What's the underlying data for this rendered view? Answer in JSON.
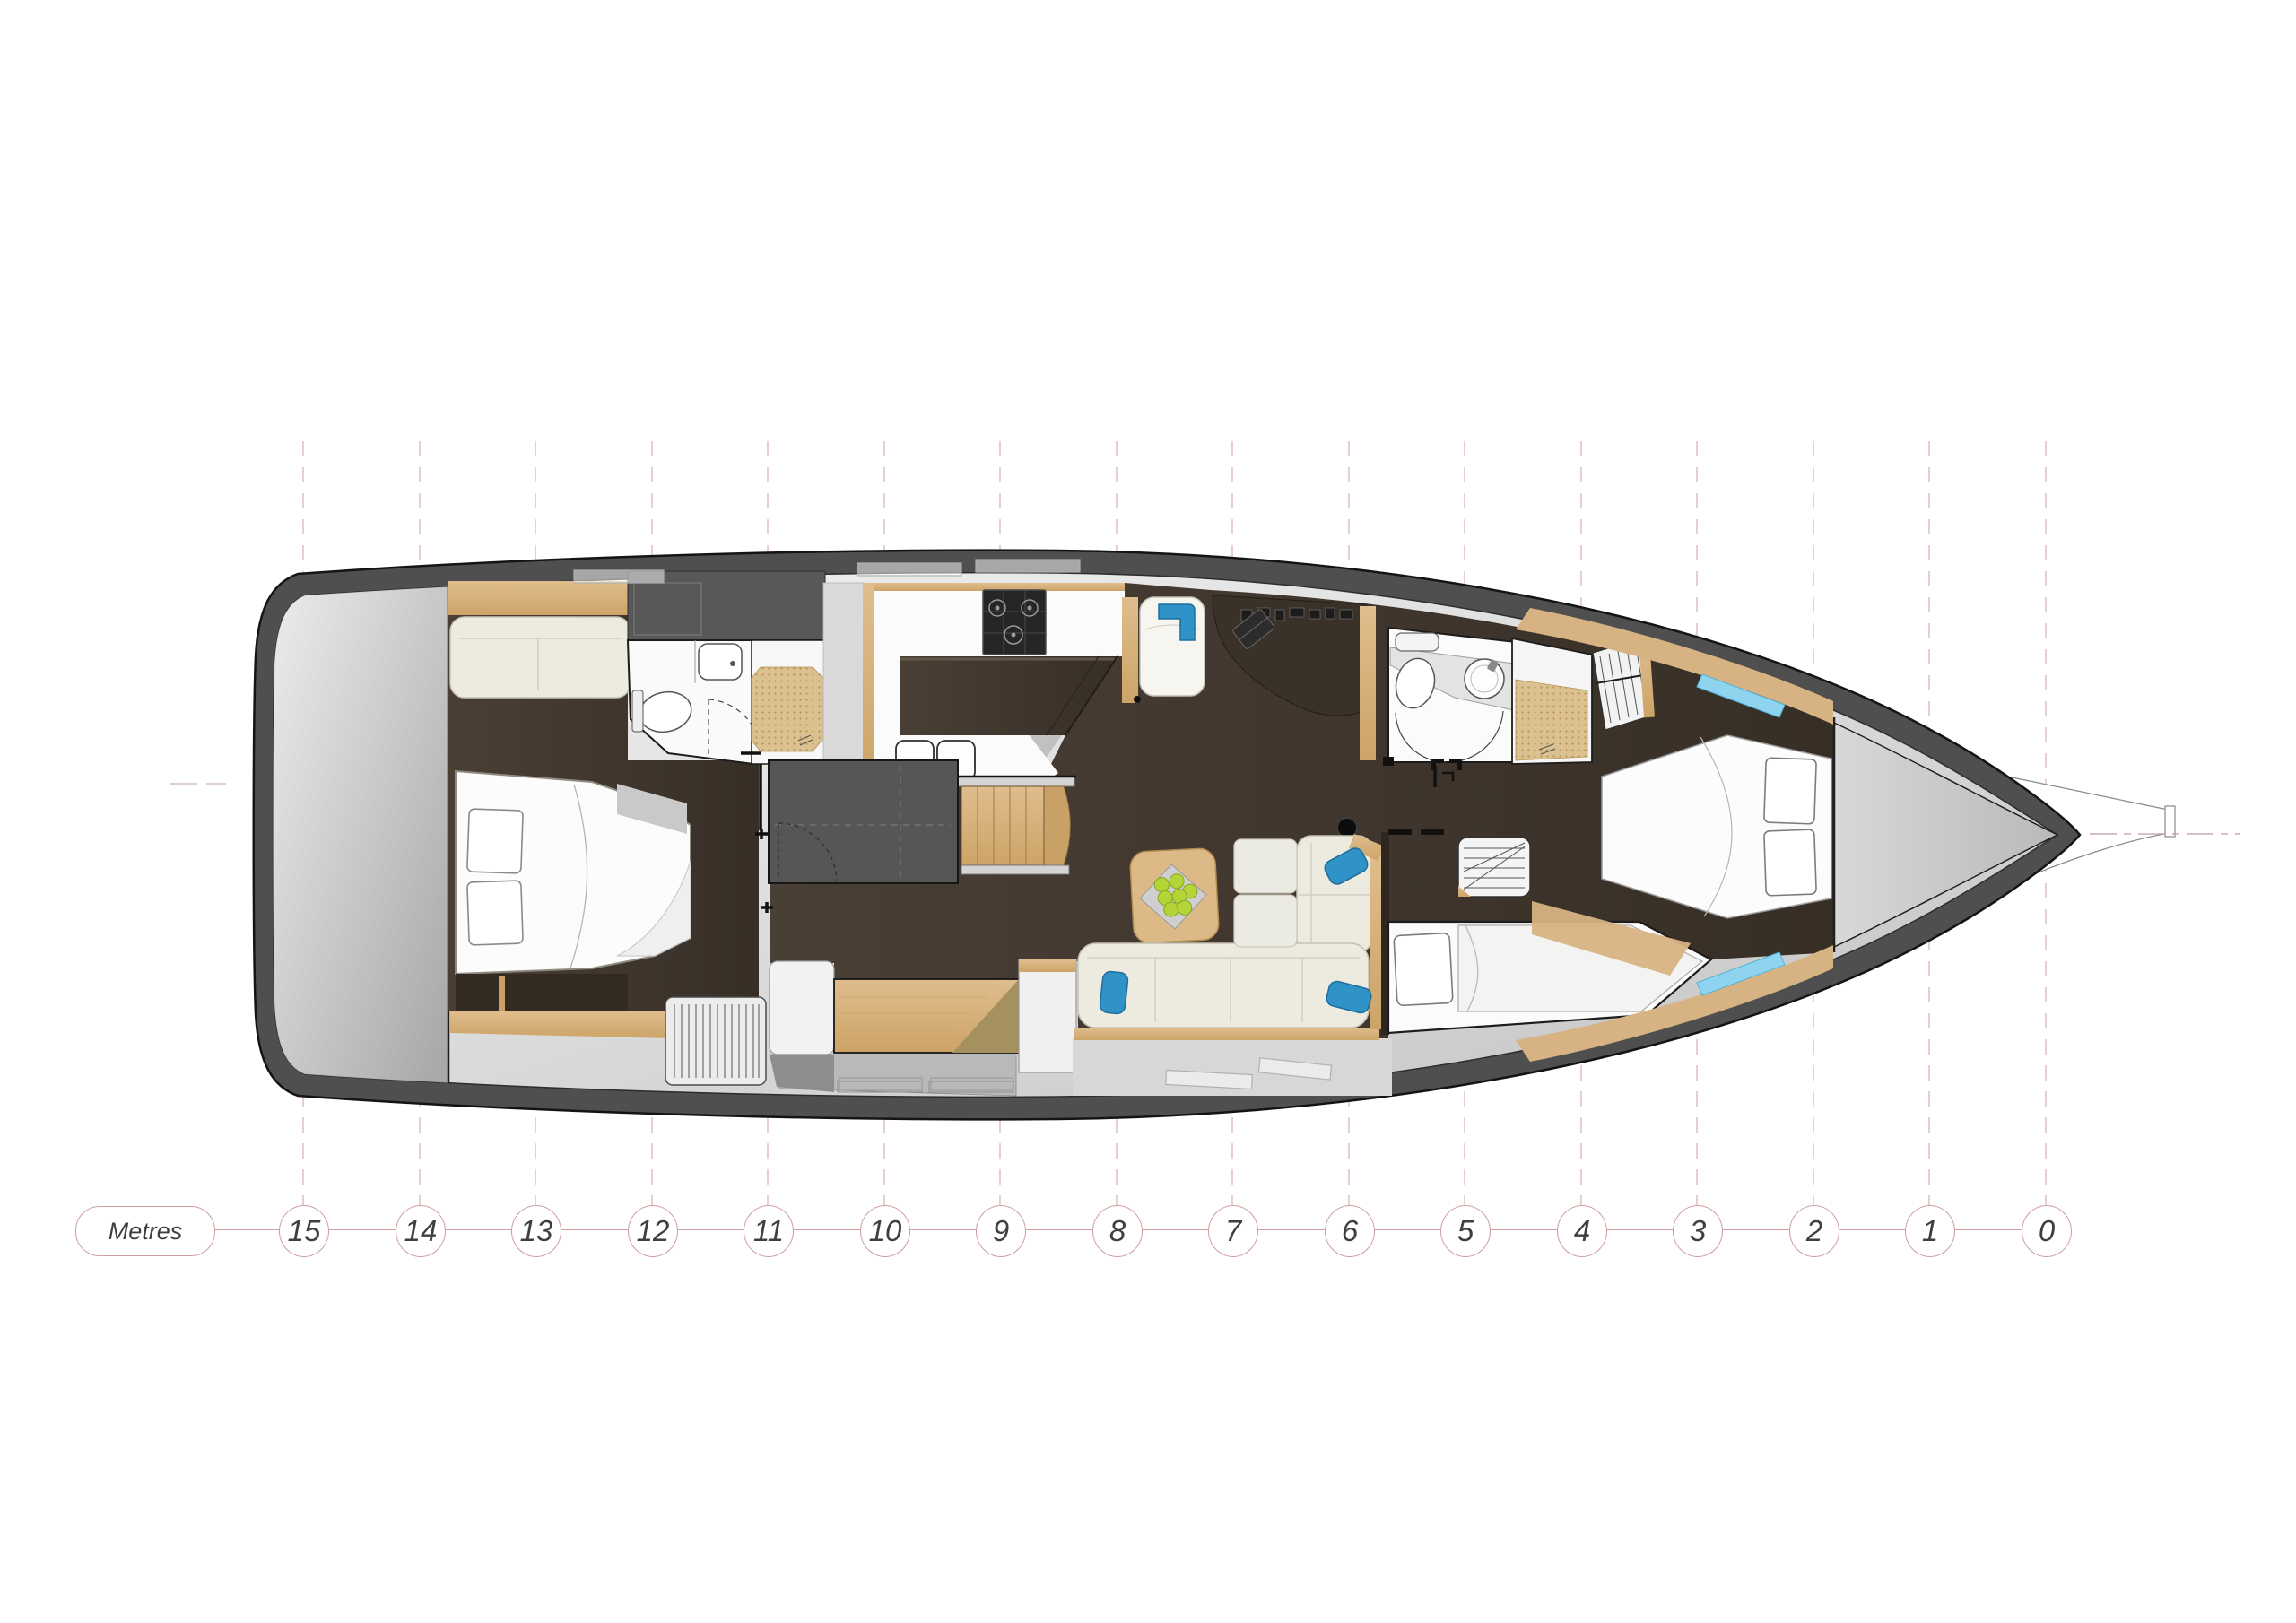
{
  "scale": {
    "unit_label": "Metres",
    "ticks": [
      "15",
      "14",
      "13",
      "12",
      "11",
      "10",
      "9",
      "8",
      "7",
      "6",
      "5",
      "4",
      "3",
      "2",
      "1",
      "0"
    ]
  },
  "colors": {
    "accent_blue": "#2f93c7",
    "wood_light": "#d9b585",
    "hull_dark": "#4f4f4f",
    "deck_light": "#dcdcdc",
    "floor_espresso": "#42382e",
    "upholstery_cream": "#edeae0",
    "hatch_cyan": "#8fd4ef",
    "fruit_green": "#b5d437",
    "scale_pink": "#cf9f9f",
    "grid_pink": "#dcbbbb",
    "label_gray": "#3f3f3f",
    "wicker_tan": "#dcc190"
  }
}
